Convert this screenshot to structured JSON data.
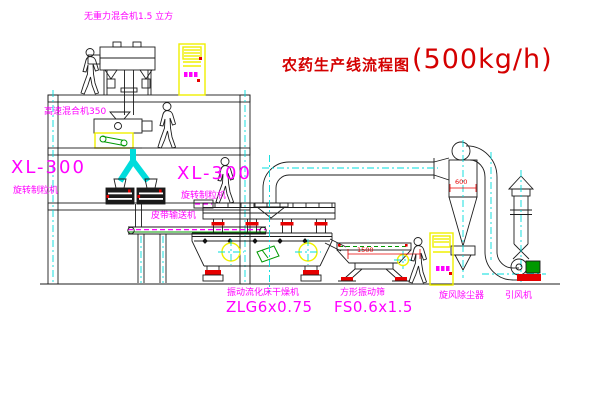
{
  "diagram": {
    "title": {
      "text": "农药生产线流程图",
      "capacity": "(500kg/h)"
    },
    "labels": {
      "gravity_mixer": "无重力混合机1.5 立方",
      "high_speed_mixer": "高速混合机350",
      "granulator_left": {
        "model": "XL-300",
        "name": "旋转制粒机"
      },
      "granulator_right": {
        "model": "XL-300",
        "name": "旋转制粒机"
      },
      "belt_conveyor": "皮带输送机",
      "dryer": {
        "name": "振动流化床干燥机",
        "model": "ZLG6x0.75"
      },
      "sieve": {
        "name": "方形振动筛",
        "model": "FS0.6x1.5"
      },
      "cyclone": "旋风除尘器",
      "fan": "引风机"
    },
    "dims": {
      "cyclone_diameter": "600",
      "sieve_length": "1500"
    },
    "colors": {
      "line": "#1c1c1c",
      "centerline_cyan": "#00dcdc",
      "label_magenta": "#ff00ff",
      "title_red": "#d40000",
      "accent_red": "#e60000",
      "highlight_yellow": "#f0f000",
      "detail_green": "#009900",
      "background": "#ffffff"
    }
  }
}
